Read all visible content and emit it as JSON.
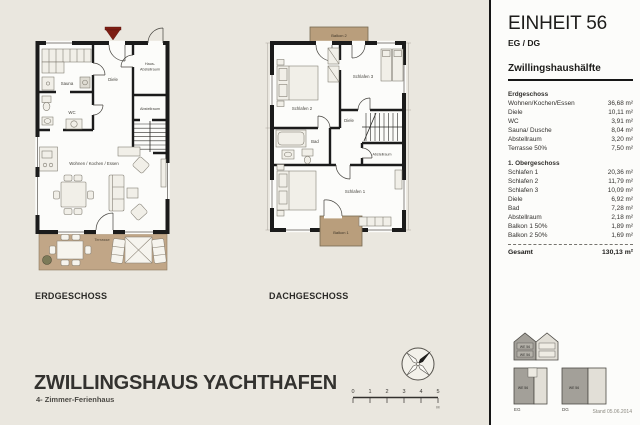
{
  "page": {
    "background": "#eae7df"
  },
  "sidebar": {
    "unit_title": "EINHEIT 56",
    "unit_subtitle": "EG / DG",
    "section_heading": "Zwillingshaushälfte",
    "groups": [
      {
        "heading": "Erdgeschoss",
        "rows": [
          {
            "label": "Wohnen/Kochen/Essen",
            "value": "36,68 m²"
          },
          {
            "label": "Diele",
            "value": "10,11 m²"
          },
          {
            "label": "WC",
            "value": "3,91 m²"
          },
          {
            "label": "Sauna/ Dusche",
            "value": "8,04 m²"
          },
          {
            "label": "Abstellraum",
            "value": "3,20 m²"
          },
          {
            "label": "Terrasse 50%",
            "value": "7,50 m²"
          }
        ]
      },
      {
        "heading": "1. Obergeschoss",
        "rows": [
          {
            "label": "Schlafen 1",
            "value": "20,36 m²"
          },
          {
            "label": "Schlafen 2",
            "value": "11,79 m²"
          },
          {
            "label": "Schlafen 3",
            "value": "10,09 m²"
          },
          {
            "label": "Diele",
            "value": "6,92 m²"
          },
          {
            "label": "Bad",
            "value": "7,28 m²"
          },
          {
            "label": "Abstellraum",
            "value": "2,18 m²"
          },
          {
            "label": "Balkon 1 50%",
            "value": "1,89 m²"
          },
          {
            "label": "Balkon 2 50%",
            "value": "1,69 m²"
          }
        ]
      }
    ],
    "total": {
      "label": "Gesamt",
      "value": "130,13 m²"
    },
    "key": {
      "unit_label": "WE 56",
      "eg_label": "EG",
      "dg_label": "DG",
      "stand_note": "Stand 05.06.2014"
    }
  },
  "plans": {
    "erdgeschoss": {
      "title": "ERDGESCHOSS",
      "rooms": {
        "sauna": "Sauna",
        "wc": "WC",
        "diele": "Diele",
        "haus_abstellraum_line1": "Haus-",
        "haus_abstellraum_line2": "Abstellraum",
        "abstellraum": "Abstellraum",
        "wohnen": "Wohnen / Kochen / Essen",
        "terrasse": "Terrasse"
      }
    },
    "dachgeschoss": {
      "title": "DACHGESCHOSS",
      "rooms": {
        "balkon2": "Balkon 2",
        "schlafen2": "Schlafen 2",
        "schlafen3": "Schlafen 3",
        "diele": "Diele",
        "bad": "Bad",
        "abstellraum": "Abstellraum",
        "schlafen1": "Schlafen 1",
        "balkon1": "Balkon 1"
      }
    }
  },
  "footer": {
    "title": "ZWILLINGSHAUS YACHTHAFEN",
    "subtitle": "4- Zimmer-Ferienhaus"
  },
  "scalebar": {
    "ticks": [
      "0",
      "1",
      "2",
      "3",
      "4",
      "5"
    ],
    "unit_label": "M"
  },
  "colors": {
    "wall": "#1b1b1b",
    "terrace_tan": "#c1a687",
    "balcony_tan": "#b99e7c",
    "entry_marker_red": "#7e1e14"
  }
}
